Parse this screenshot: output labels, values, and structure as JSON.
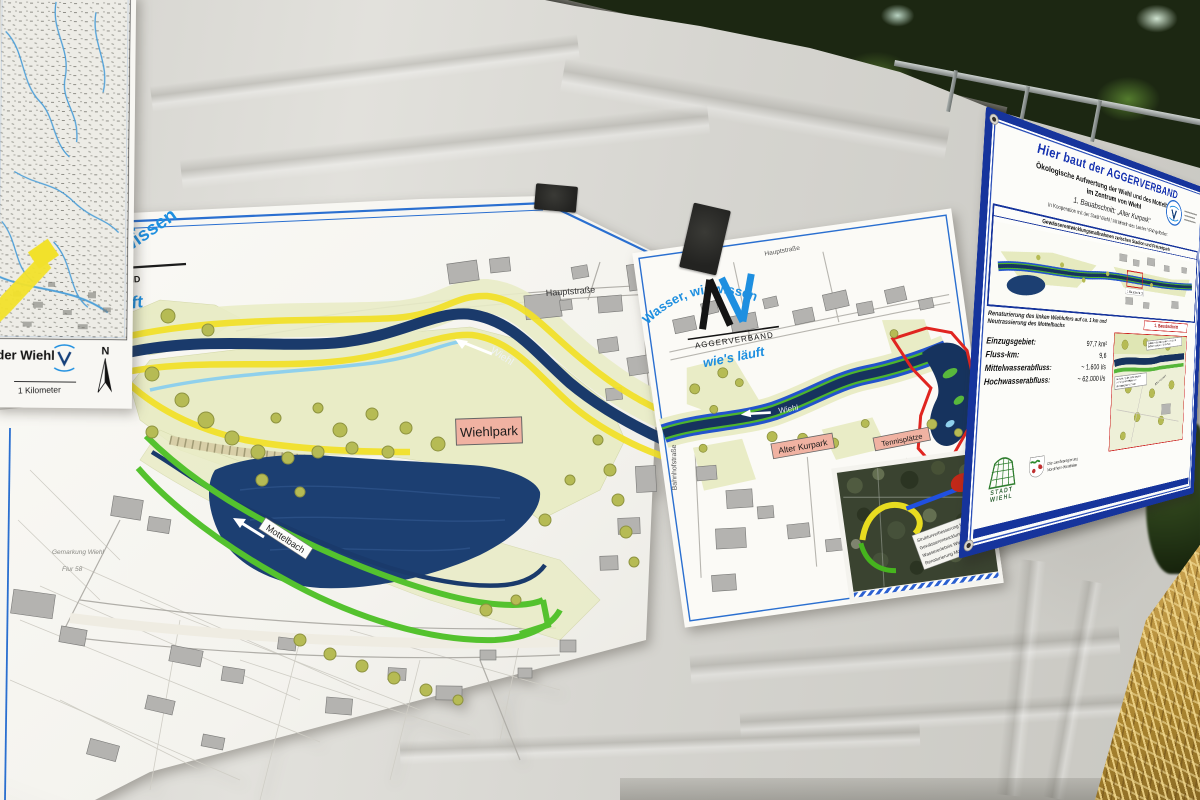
{
  "topo_poster": {
    "area_label": "der Wiehl",
    "scale_label": "1 Kilometer",
    "north_label": "N"
  },
  "left_poster": {
    "header": {
      "slogan_fragment": "wissen",
      "brand_fragment": "AND",
      "slogan2_fragment": "uft"
    },
    "labels": {
      "street": "Hauptstraße",
      "river": "Wiehl",
      "park": "Wiehlpark",
      "creek": "Mottelbach",
      "district": "Gemarkung Wiehl",
      "parcel": "Flur 58"
    }
  },
  "center_poster": {
    "slogan_top": "Wasser, wir wissen",
    "brand": "AGGERVERBAND",
    "slogan_bottom": "wie's läuft",
    "labels": {
      "street_top": "Hauptstraße",
      "river": "Wiehl",
      "old_park": "Alter Kurpark",
      "tennis": "Tennisplätze",
      "street_left": "Bahnhofstraße"
    },
    "aerial_legend": [
      "Strukturverbesserung Wiehl",
      "Gewässerentwicklung Wiehl",
      "Wassererlebnis Wiehlpark",
      "Renaturierung Mottelbach"
    ]
  },
  "banner": {
    "title": "Hier baut der AGGERVERBAND",
    "subtitle_line1": "Ökologische Aufwertung der Wiehl und des Mottelbachs",
    "subtitle_line2": "im Zentrum von Wiehl",
    "section": "1. Bauabschnitt: „Alter Kurpark“",
    "cooperation": "In Kooperation mit der Stadt Wiehl | Mit Mitteln des Landes NRW gefördert",
    "inset_title": "Gewässerentwicklungsmaßnahmen zwischen Stadion und Freizeitpark",
    "inset_caption": "Renaturierung des linken Wiehlufers auf ca. 1 km und Neutrassierung des Mottelbachs",
    "section_label": "1. Bauabschnitt",
    "stats": [
      {
        "label": "Einzugsgebiet:",
        "value": "97,7 km²"
      },
      {
        "label": "Fluss-km:",
        "value": "9,6"
      },
      {
        "label": "Mittelwasserabfluss:",
        "value": "~ 1.600 l/s"
      },
      {
        "label": "Hochwasserabfluss:",
        "value": "~ 62.000 l/s"
      }
    ],
    "plan_annotation_top": "Natürliche Gestaltung des Ufers durch Erdbewegung und Holzeinbau",
    "plan_annotation_left": "Aufweitung der Sohle bewirkt vielfältigere Breiten- und Strömungsverhältnisse",
    "plan_label": "Alter Kurpark",
    "stadt_logo_text": "STADT WIEHL",
    "nrw_logo_line1": "Die Landesregierung",
    "nrw_logo_line2": "Nordrhein-Westfalen"
  },
  "colors": {
    "slogan_blue": "#1e8fe0",
    "banner_blue": "#16349c",
    "river_navy": "#1a3a6b",
    "construction_yellow": "#f2e12b",
    "construction_green": "#54c22e",
    "boundary_red": "#e02520",
    "label_pink": "#f0b2a2"
  }
}
